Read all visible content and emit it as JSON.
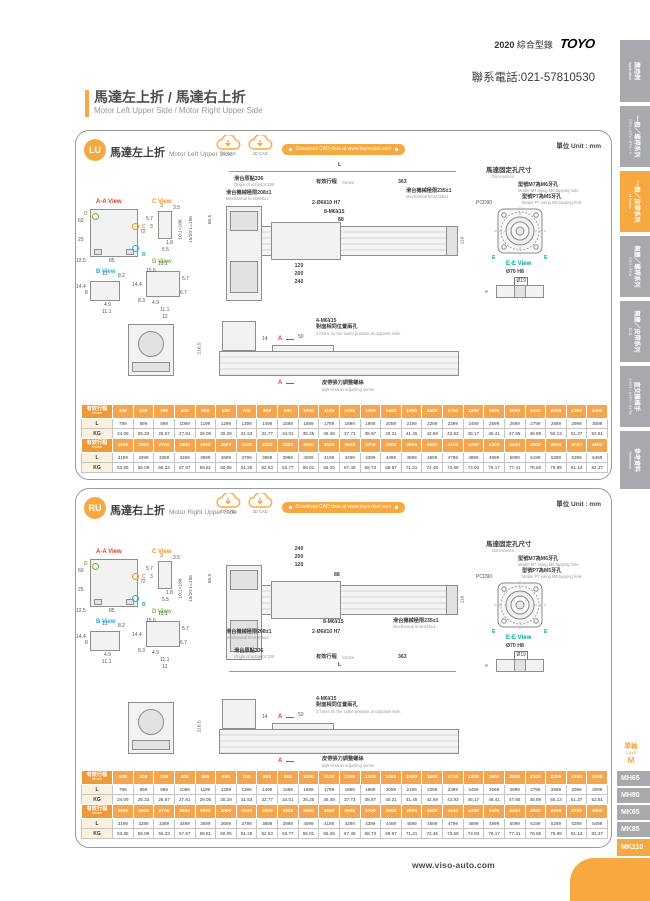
{
  "header": {
    "year": "2020",
    "catalog": "綜合型錄",
    "brand": "TOYO",
    "phone": "聯系電話:021-57810530"
  },
  "page_title": {
    "zh": "馬達左上折 / 馬達右上折",
    "en": "Motor Left Upper Side / Motor Right Upper Side"
  },
  "sidebar": {
    "tabs": [
      {
        "zh": "應用例",
        "en": "Application",
        "active": false
      },
      {
        "zh": "一般／螺桿系列",
        "en": "GTH / GTY / ETH / Y",
        "active": false
      },
      {
        "zh": "一般／皮帶系列",
        "en": "M Series",
        "active": true
      },
      {
        "zh": "無塵／螺桿系列",
        "en": "GCH / ECH",
        "active": false
      },
      {
        "zh": "無塵／皮帶系列",
        "en": "ECB",
        "active": false
      },
      {
        "zh": "直交機械手",
        "en": "XYGT / XYTH / XYTB",
        "active": false
      },
      {
        "zh": "參考資料",
        "en": "Reference",
        "active": false
      }
    ]
  },
  "panel_lu": {
    "badge": "LU",
    "title_zh": "馬達左上折",
    "title_en": "Motor Left Upper Side",
    "cad2d": "2D CAD",
    "cad3d": "3D CAD",
    "download": "Download CAD data at www.toyorobot.com",
    "unit": "單位 Unit : mm"
  },
  "panel_ru": {
    "badge": "RU",
    "title_zh": "馬達右上折",
    "title_en": "Motor Right Upper Side",
    "cad2d": "2D CAD",
    "cad3d": "3D CAD",
    "download": "Download CAD data at www.toyorobot.com",
    "unit": "單位 Unit : mm"
  },
  "drawing": {
    "dim_L": "L",
    "origin_zh": "滑台原點336",
    "origin_en": "Origin of actuator:336",
    "stroke_zh": "有效行程",
    "stroke_en": "Stroke",
    "dim_363": "363",
    "mech208_zh": "滑台機械極限208±1",
    "mech208_en": "Mechanical limit:208±1",
    "mech235_zh": "滑台機械極限235±1",
    "mech235_en": "Mechanical limit:235±1",
    "hole_pin": "2-Ø6¥10 H7",
    "hole_m6": "8-M6¥15",
    "dim_88": "88",
    "dim_120": "120",
    "dim_200": "200",
    "dim_240": "240",
    "dim_110": "110",
    "dim_65_5": "65.5",
    "ratio_10": "10:1=188",
    "ratio_15": "15/20:1=196",
    "motor_zh": "馬達固定孔尺寸",
    "motor_en": "Dimensions",
    "m7_zh": "型號M7為M6牙孔",
    "m7_en": "Model M7 using M6 tapping hole",
    "p7_zh": "型號P7為M5牙孔",
    "p7_en": "Model P7 using M5 tapping hole",
    "pcd": "PCD90",
    "e": "E",
    "ee_view": "E-E View",
    "d70": "Ø70 H8",
    "d19": "Ø19",
    "dim_9": "9",
    "aa_view": "A-A View",
    "c_view": "C View",
    "b_view": "B View",
    "d_view": "D View",
    "aa": {
      "d25": "25",
      "d60": "60",
      "d12_5": "12.5",
      "d85": "85",
      "d72": "72",
      "b": "B",
      "c": "C",
      "d": "D"
    },
    "cv": {
      "d3a": "3",
      "d3_5": "3.5",
      "d5_7": "5.7",
      "d3b": "3",
      "d1_8": "1.8",
      "d5_5": "5.5"
    },
    "bv": {
      "d12": "12",
      "d8_2": "8.2",
      "d14_4": "14.4",
      "d8": "8",
      "d4_9": "4.9",
      "d11_1": "11.1"
    },
    "dv": {
      "d19_1": "19.1",
      "d15_6": "15.6",
      "d5_7": "5.7",
      "d14_4": "14.4",
      "d8_3": "8.3",
      "d4_9": "4.9",
      "d6_7": "6.7",
      "d11_1": "11.1",
      "d12": "12"
    },
    "dim_216_5": "216.5",
    "dim_14": "14",
    "dim_50": "50",
    "m4_zh": "4-M6¥15",
    "m4_zh2": "對面相同位置兩孔",
    "m4_en": "2 holes on the same position at opposite side.",
    "a_marker": "A",
    "belt_zh": "皮帶張力調整螺絲",
    "belt_en": "Belt tension adjusting screw."
  },
  "tables": {
    "head_zh": "有效行程",
    "head_en": "Stroke",
    "row_l": "L",
    "row_kg": "KG",
    "t1": {
      "strokes": [
        100,
        200,
        300,
        400,
        500,
        600,
        700,
        800,
        900,
        1000,
        1100,
        1200,
        1300,
        1400,
        1500,
        1600,
        1700,
        1800,
        1900,
        2000,
        2100,
        2200,
        2300,
        2400
      ],
      "L": [
        799,
        899,
        999,
        1099,
        1199,
        1299,
        1399,
        1499,
        1599,
        1699,
        1799,
        1899,
        1999,
        2099,
        2199,
        2299,
        2399,
        2499,
        2599,
        2699,
        2799,
        2899,
        2999,
        3099
      ],
      "KG": [
        "24.09",
        "25.33",
        "26.57",
        "27.81",
        "29.05",
        "30.29",
        "31.53",
        "32.77",
        "34.01",
        "35.25",
        "36.49",
        "37.73",
        "38.97",
        "40.21",
        "41.45",
        "42.69",
        "43.93",
        "45.17",
        "46.41",
        "47.65",
        "48.89",
        "50.13",
        "51.37",
        "52.61"
      ]
    },
    "t2": {
      "strokes": [
        2500,
        2600,
        2700,
        2800,
        2900,
        3000,
        3100,
        3200,
        3300,
        3400,
        3500,
        3600,
        3700,
        3800,
        3900,
        4000,
        4100,
        4200,
        4300,
        4400,
        4500,
        4600,
        4700,
        4800
      ],
      "L": [
        3199,
        3299,
        3399,
        3499,
        3599,
        3699,
        3799,
        3899,
        3999,
        4099,
        4199,
        4299,
        4399,
        4499,
        4599,
        4699,
        4799,
        4899,
        4999,
        5099,
        5199,
        5299,
        5399,
        5499
      ],
      "KG": [
        "53.85",
        "55.09",
        "56.33",
        "57.57",
        "58.81",
        "60.05",
        "61.29",
        "62.53",
        "63.77",
        "65.01",
        "66.25",
        "67.49",
        "68.73",
        "69.97",
        "71.21",
        "72.45",
        "73.69",
        "74.93",
        "76.17",
        "77.41",
        "78.65",
        "79.89",
        "81.13",
        "82.37"
      ]
    }
  },
  "axis_nav": {
    "group_zh": "單軸",
    "group_en": "1 axis",
    "series": "M",
    "items": [
      "MH65",
      "MH80",
      "MK65",
      "MK85",
      "MK110"
    ],
    "active": "MK110"
  },
  "footer": {
    "url": "www.viso-auto.com"
  },
  "colors": {
    "accent": "#F7A941",
    "tab_gray": "#A7A9AC",
    "view_a": "#D6442B",
    "view_b": "#2BAAE1",
    "view_c": "#F7941D",
    "view_d": "#7CB942",
    "view_e": "#00A99D"
  }
}
